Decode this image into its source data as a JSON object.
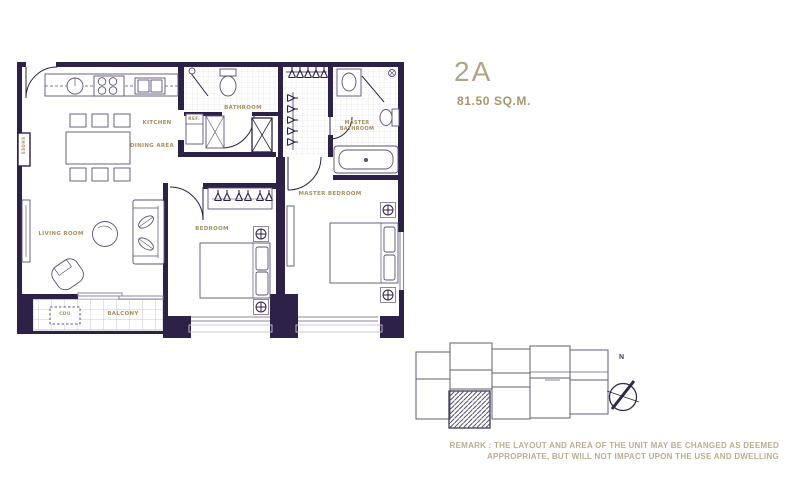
{
  "unit": {
    "name": "2A",
    "area": "81.50 SQ.M."
  },
  "rooms": {
    "living_room": "LIVING ROOM",
    "kitchen": "KITCHEN",
    "dining_area": "DINING AREA",
    "bathroom": "BATHROOM",
    "bedroom": "BEDROOM",
    "master_bedroom": "MASTER BEDROOM",
    "master_bathroom": "MASTER BATHROOM",
    "balcony": "BALCONY",
    "refrigerator": "REF.",
    "shoes": "SHOES",
    "cdu": "CDU"
  },
  "compass": {
    "north": "N"
  },
  "remark": {
    "line1": "REMARK : THE LAYOUT AND AREA OF THE UNIT MAY BE CHANGED AS DEEMED",
    "line2": "APPROPRIATE, BUT WILL NOT IMPACT UPON THE USE AND DWELLING"
  },
  "colors": {
    "wall": "#2e2147",
    "label": "#a5905e",
    "title": "#b2a382",
    "remark": "#b9ae92"
  }
}
